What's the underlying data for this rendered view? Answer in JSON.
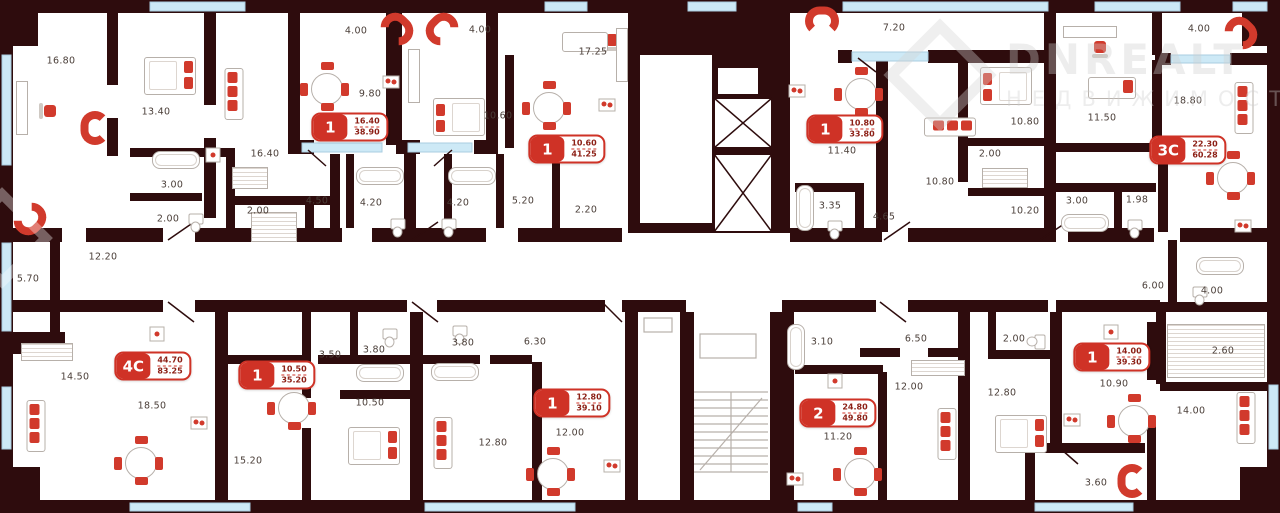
{
  "watermark": {
    "line1": "DNREALT",
    "line2": "НЕДВИЖИМОСТЬ"
  },
  "colors": {
    "wall": "#2e0c0d",
    "accent_red": "#d13a2c",
    "badge_red": "#cf3226",
    "window_blue": "#cde9f6",
    "fixture_gray": "#b7b0aa",
    "label_text": "#4a3e38"
  },
  "apartments": [
    {
      "rooms": "1",
      "area_living": "16.40",
      "area_total": "38.90",
      "x": 350,
      "y": 127
    },
    {
      "rooms": "1",
      "area_living": "10.60",
      "area_total": "41.25",
      "x": 567,
      "y": 149
    },
    {
      "rooms": "1",
      "area_living": "10.80",
      "area_total": "33.80",
      "x": 845,
      "y": 129
    },
    {
      "rooms": "3С",
      "area_living": "22.30",
      "area_total": "60.28",
      "x": 1188,
      "y": 150
    },
    {
      "rooms": "4С",
      "area_living": "44.70",
      "area_total": "83.25",
      "x": 153,
      "y": 366
    },
    {
      "rooms": "1",
      "area_living": "10.50",
      "area_total": "35.20",
      "x": 277,
      "y": 375
    },
    {
      "rooms": "1",
      "area_living": "12.80",
      "area_total": "39.10",
      "x": 572,
      "y": 403
    },
    {
      "rooms": "2",
      "area_living": "24.80",
      "area_total": "49.80",
      "x": 838,
      "y": 413
    },
    {
      "rooms": "1",
      "area_living": "14.00",
      "area_total": "39.30",
      "x": 1112,
      "y": 357
    }
  ],
  "labels": [
    {
      "text": "16.80",
      "x": 61,
      "y": 61
    },
    {
      "text": "13.40",
      "x": 156,
      "y": 112
    },
    {
      "text": "16.40",
      "x": 265,
      "y": 154
    },
    {
      "text": "3.00",
      "x": 172,
      "y": 185
    },
    {
      "text": "2.00",
      "x": 168,
      "y": 219
    },
    {
      "text": "2.00",
      "x": 258,
      "y": 211
    },
    {
      "text": "12.20",
      "x": 103,
      "y": 257
    },
    {
      "text": "5.70",
      "x": 28,
      "y": 279
    },
    {
      "text": "4.00",
      "x": 356,
      "y": 31
    },
    {
      "text": "4.00",
      "x": 480,
      "y": 30
    },
    {
      "text": "9.80",
      "x": 370,
      "y": 94
    },
    {
      "text": "10.60",
      "x": 498,
      "y": 116
    },
    {
      "text": "17.25",
      "x": 593,
      "y": 52
    },
    {
      "text": "4.50",
      "x": 317,
      "y": 201
    },
    {
      "text": "4.20",
      "x": 371,
      "y": 203
    },
    {
      "text": "4.20",
      "x": 458,
      "y": 203
    },
    {
      "text": "5.20",
      "x": 523,
      "y": 201
    },
    {
      "text": "2.20",
      "x": 586,
      "y": 210
    },
    {
      "text": "11.40",
      "x": 842,
      "y": 151
    },
    {
      "text": "3.35",
      "x": 830,
      "y": 206
    },
    {
      "text": "7.20",
      "x": 894,
      "y": 28
    },
    {
      "text": "10.80",
      "x": 940,
      "y": 182
    },
    {
      "text": "10.80",
      "x": 1025,
      "y": 122
    },
    {
      "text": "2.00",
      "x": 990,
      "y": 154
    },
    {
      "text": "10.20",
      "x": 1025,
      "y": 211
    },
    {
      "text": "4.65",
      "x": 884,
      "y": 217
    },
    {
      "text": "4.00",
      "x": 1199,
      "y": 29
    },
    {
      "text": "11.50",
      "x": 1102,
      "y": 118
    },
    {
      "text": "18.80",
      "x": 1188,
      "y": 101
    },
    {
      "text": "3.00",
      "x": 1077,
      "y": 201
    },
    {
      "text": "1.98",
      "x": 1137,
      "y": 200
    },
    {
      "text": "14.50",
      "x": 75,
      "y": 377
    },
    {
      "text": "18.50",
      "x": 152,
      "y": 406
    },
    {
      "text": "15.20",
      "x": 248,
      "y": 461
    },
    {
      "text": "3.50",
      "x": 330,
      "y": 355
    },
    {
      "text": "3.80",
      "x": 374,
      "y": 350
    },
    {
      "text": "3.80",
      "x": 463,
      "y": 343
    },
    {
      "text": "6.30",
      "x": 535,
      "y": 342
    },
    {
      "text": "10.50",
      "x": 370,
      "y": 403
    },
    {
      "text": "12.80",
      "x": 493,
      "y": 443
    },
    {
      "text": "12.00",
      "x": 570,
      "y": 433
    },
    {
      "text": "3.10",
      "x": 822,
      "y": 342
    },
    {
      "text": "11.20",
      "x": 838,
      "y": 437
    },
    {
      "text": "6.50",
      "x": 916,
      "y": 339
    },
    {
      "text": "2.00",
      "x": 1014,
      "y": 339
    },
    {
      "text": "12.00",
      "x": 909,
      "y": 387
    },
    {
      "text": "12.80",
      "x": 1002,
      "y": 393
    },
    {
      "text": "6.00",
      "x": 1153,
      "y": 286
    },
    {
      "text": "4.00",
      "x": 1212,
      "y": 291
    },
    {
      "text": "10.90",
      "x": 1114,
      "y": 384
    },
    {
      "text": "2.60",
      "x": 1223,
      "y": 351
    },
    {
      "text": "14.00",
      "x": 1191,
      "y": 411
    },
    {
      "text": "3.60",
      "x": 1096,
      "y": 483
    }
  ],
  "furniture": [
    {
      "t": "u",
      "x": 95,
      "y": 128,
      "r": -90
    },
    {
      "t": "u",
      "x": 30,
      "y": 219,
      "r": 135
    },
    {
      "t": "u",
      "x": 397,
      "y": 29,
      "r": 45
    },
    {
      "t": "u",
      "x": 442,
      "y": 29,
      "r": -45
    },
    {
      "t": "u",
      "x": 822,
      "y": 21,
      "r": 0
    },
    {
      "t": "u",
      "x": 1241,
      "y": 33,
      "r": 45
    },
    {
      "t": "u",
      "x": 1132,
      "y": 481,
      "r": -90
    },
    {
      "t": "table",
      "x": 327,
      "y": 89
    },
    {
      "t": "table",
      "x": 549,
      "y": 108
    },
    {
      "t": "table",
      "x": 861,
      "y": 94
    },
    {
      "t": "table",
      "x": 1233,
      "y": 178
    },
    {
      "t": "table",
      "x": 141,
      "y": 463
    },
    {
      "t": "table",
      "x": 294,
      "y": 408
    },
    {
      "t": "table",
      "x": 553,
      "y": 474
    },
    {
      "t": "table",
      "x": 860,
      "y": 474
    },
    {
      "t": "table",
      "x": 1134,
      "y": 421
    },
    {
      "t": "bed",
      "x": 170,
      "y": 76,
      "r": 0
    },
    {
      "t": "bed",
      "x": 459,
      "y": 117,
      "r": 180
    },
    {
      "t": "bed",
      "x": 1006,
      "y": 86,
      "r": 180
    },
    {
      "t": "bed",
      "x": 374,
      "y": 446,
      "r": 0
    },
    {
      "t": "bed",
      "x": 1021,
      "y": 434,
      "r": 0
    },
    {
      "t": "bed-s",
      "x": 1112,
      "y": 88,
      "r": 0
    },
    {
      "t": "sofa",
      "x": 234,
      "y": 94,
      "r": 0
    },
    {
      "t": "sofa",
      "x": 950,
      "y": 127,
      "r": 90
    },
    {
      "t": "sofa",
      "x": 1244,
      "y": 108,
      "r": 0
    },
    {
      "t": "sofa",
      "x": 36,
      "y": 426,
      "r": 0
    },
    {
      "t": "sofa",
      "x": 443,
      "y": 443,
      "r": 0
    },
    {
      "t": "sofa",
      "x": 947,
      "y": 434,
      "r": 0
    },
    {
      "t": "sofa",
      "x": 1246,
      "y": 418,
      "r": 0
    },
    {
      "t": "chair",
      "x": 50,
      "y": 111,
      "r": -90
    },
    {
      "t": "chair",
      "x": 612,
      "y": 40,
      "r": 180
    },
    {
      "t": "chair",
      "x": 1100,
      "y": 47,
      "r": 180
    },
    {
      "t": "stove",
      "x": 391,
      "y": 82
    },
    {
      "t": "stove",
      "x": 607,
      "y": 105
    },
    {
      "t": "stove",
      "x": 797,
      "y": 91
    },
    {
      "t": "stove",
      "x": 1243,
      "y": 226
    },
    {
      "t": "stove",
      "x": 199,
      "y": 423
    },
    {
      "t": "stove",
      "x": 612,
      "y": 466
    },
    {
      "t": "stove",
      "x": 795,
      "y": 479
    },
    {
      "t": "stove",
      "x": 1072,
      "y": 420
    },
    {
      "t": "dotbox",
      "x": 213,
      "y": 155
    },
    {
      "t": "dotbox",
      "x": 157,
      "y": 334
    },
    {
      "t": "dotbox",
      "x": 835,
      "y": 381
    },
    {
      "t": "dotbox",
      "x": 1111,
      "y": 332
    },
    {
      "t": "bath-h",
      "x": 176,
      "y": 160
    },
    {
      "t": "bath-h",
      "x": 380,
      "y": 176
    },
    {
      "t": "bath-h",
      "x": 472,
      "y": 176
    },
    {
      "t": "bath-h",
      "x": 1085,
      "y": 223
    },
    {
      "t": "bath-h",
      "x": 380,
      "y": 373
    },
    {
      "t": "bath-h",
      "x": 455,
      "y": 372
    },
    {
      "t": "bath-h",
      "x": 1220,
      "y": 266
    },
    {
      "t": "bath-v",
      "x": 805,
      "y": 208
    },
    {
      "t": "bath-v",
      "x": 796,
      "y": 347
    },
    {
      "t": "toilet",
      "x": 196,
      "y": 219
    },
    {
      "t": "toilet",
      "x": 398,
      "y": 224
    },
    {
      "t": "toilet",
      "x": 449,
      "y": 224
    },
    {
      "t": "toilet",
      "x": 835,
      "y": 226
    },
    {
      "t": "toilet",
      "x": 1135,
      "y": 225
    },
    {
      "t": "toilet",
      "x": 1040,
      "y": 342,
      "r": 90
    },
    {
      "t": "toilet",
      "x": 390,
      "y": 334
    },
    {
      "t": "toilet",
      "x": 460,
      "y": 331
    },
    {
      "t": "toilet",
      "x": 1200,
      "y": 292
    },
    {
      "t": "couch",
      "x": 585,
      "y": 42
    },
    {
      "t": "desk",
      "x": 22,
      "y": 108
    },
    {
      "t": "desk",
      "x": 622,
      "y": 55
    },
    {
      "t": "desk",
      "x": 1090,
      "y": 32,
      "r": 90
    },
    {
      "t": "desk",
      "x": 414,
      "y": 76
    },
    {
      "t": "hatch",
      "x": 274,
      "y": 227,
      "w": 44,
      "h": 28
    },
    {
      "t": "hatch",
      "x": 1005,
      "y": 178,
      "w": 44,
      "h": 18
    },
    {
      "t": "hatch",
      "x": 1216,
      "y": 351,
      "w": 96,
      "h": 52
    },
    {
      "t": "hatch",
      "x": 47,
      "y": 352,
      "w": 50,
      "h": 16
    },
    {
      "t": "hatch",
      "x": 938,
      "y": 368,
      "w": 52,
      "h": 14
    },
    {
      "t": "hatch",
      "x": 250,
      "y": 178,
      "w": 34,
      "h": 20
    }
  ]
}
